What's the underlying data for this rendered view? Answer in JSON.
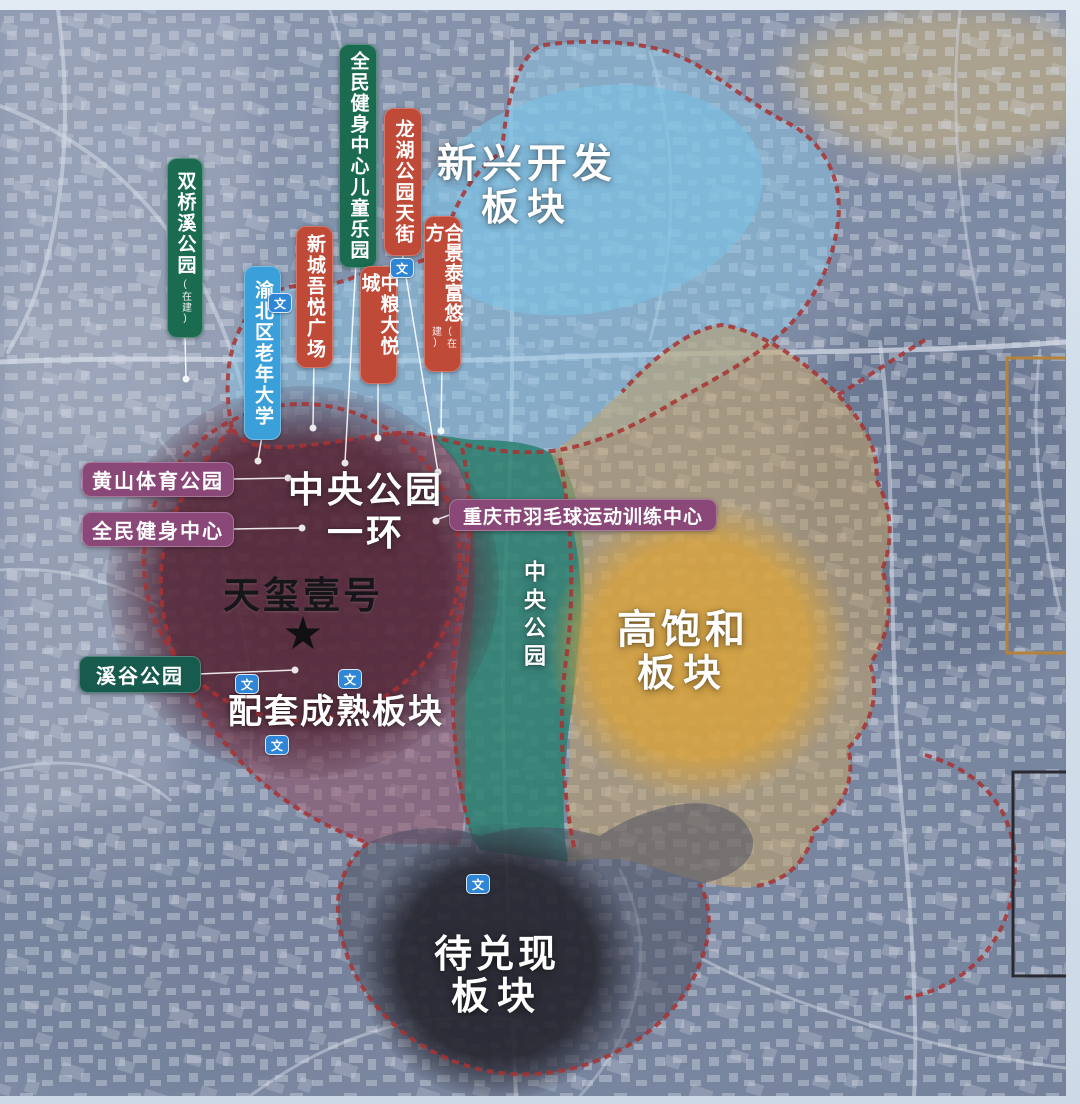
{
  "zones": {
    "emerging": {
      "name": "新兴开发板块",
      "title_line1": "新兴开发",
      "title_line2": "板块",
      "fill": "#8cc6e6"
    },
    "ring": {
      "name": "中央公园一环",
      "title_line1": "中央公园",
      "title_line2": "一环",
      "fill": "#4d2030"
    },
    "mature": {
      "name": "配套成熟板块",
      "title": "配套成熟板块",
      "fill": "#8f4a60"
    },
    "central_park": {
      "name": "中央公园",
      "title": "中央公园",
      "fill": "#2c8070"
    },
    "saturated": {
      "name": "高饱和板块",
      "title_line1": "高饱和",
      "title_line2": "板块",
      "fill": "#d9a33c"
    },
    "pending": {
      "name": "待兑现板块",
      "title_line1": "待兑现",
      "title_line2": "板块",
      "fill": "#23232c"
    }
  },
  "project": {
    "name": "天玺壹号",
    "star_glyph": "★"
  },
  "pills": [
    {
      "label": "双桥溪公园",
      "sub": "(在建)"
    },
    {
      "label": "全民健身中心儿童乐园"
    },
    {
      "label": "龙湖公园天街"
    },
    {
      "label": "新城吾悦广场"
    },
    {
      "label": "中粮大悦城"
    },
    {
      "label": "合景泰富悠方",
      "sub": "(在建)"
    },
    {
      "label": "渝北区老年大学"
    },
    {
      "label": "黄山体育公园"
    },
    {
      "label": "全民健身中心"
    },
    {
      "label": "重庆市羽毛球运动训练中心"
    },
    {
      "label": "溪谷公园"
    }
  ],
  "icons": {
    "school_glyph": "文",
    "school_color": "#2f86d6"
  },
  "colors": {
    "pill_green": "#1a6b50",
    "pill_red": "#c04a38",
    "pill_blue": "#3b9fd9",
    "pill_purple": "#8a4878",
    "pill_teal": "#175a4e",
    "boundary": "#a83232",
    "basemap": "#7e8ba4",
    "photo_margin": "#d3dfeb",
    "highlight_frame_orange": "#b5823c",
    "highlight_frame_dark": "#2a2a33"
  }
}
